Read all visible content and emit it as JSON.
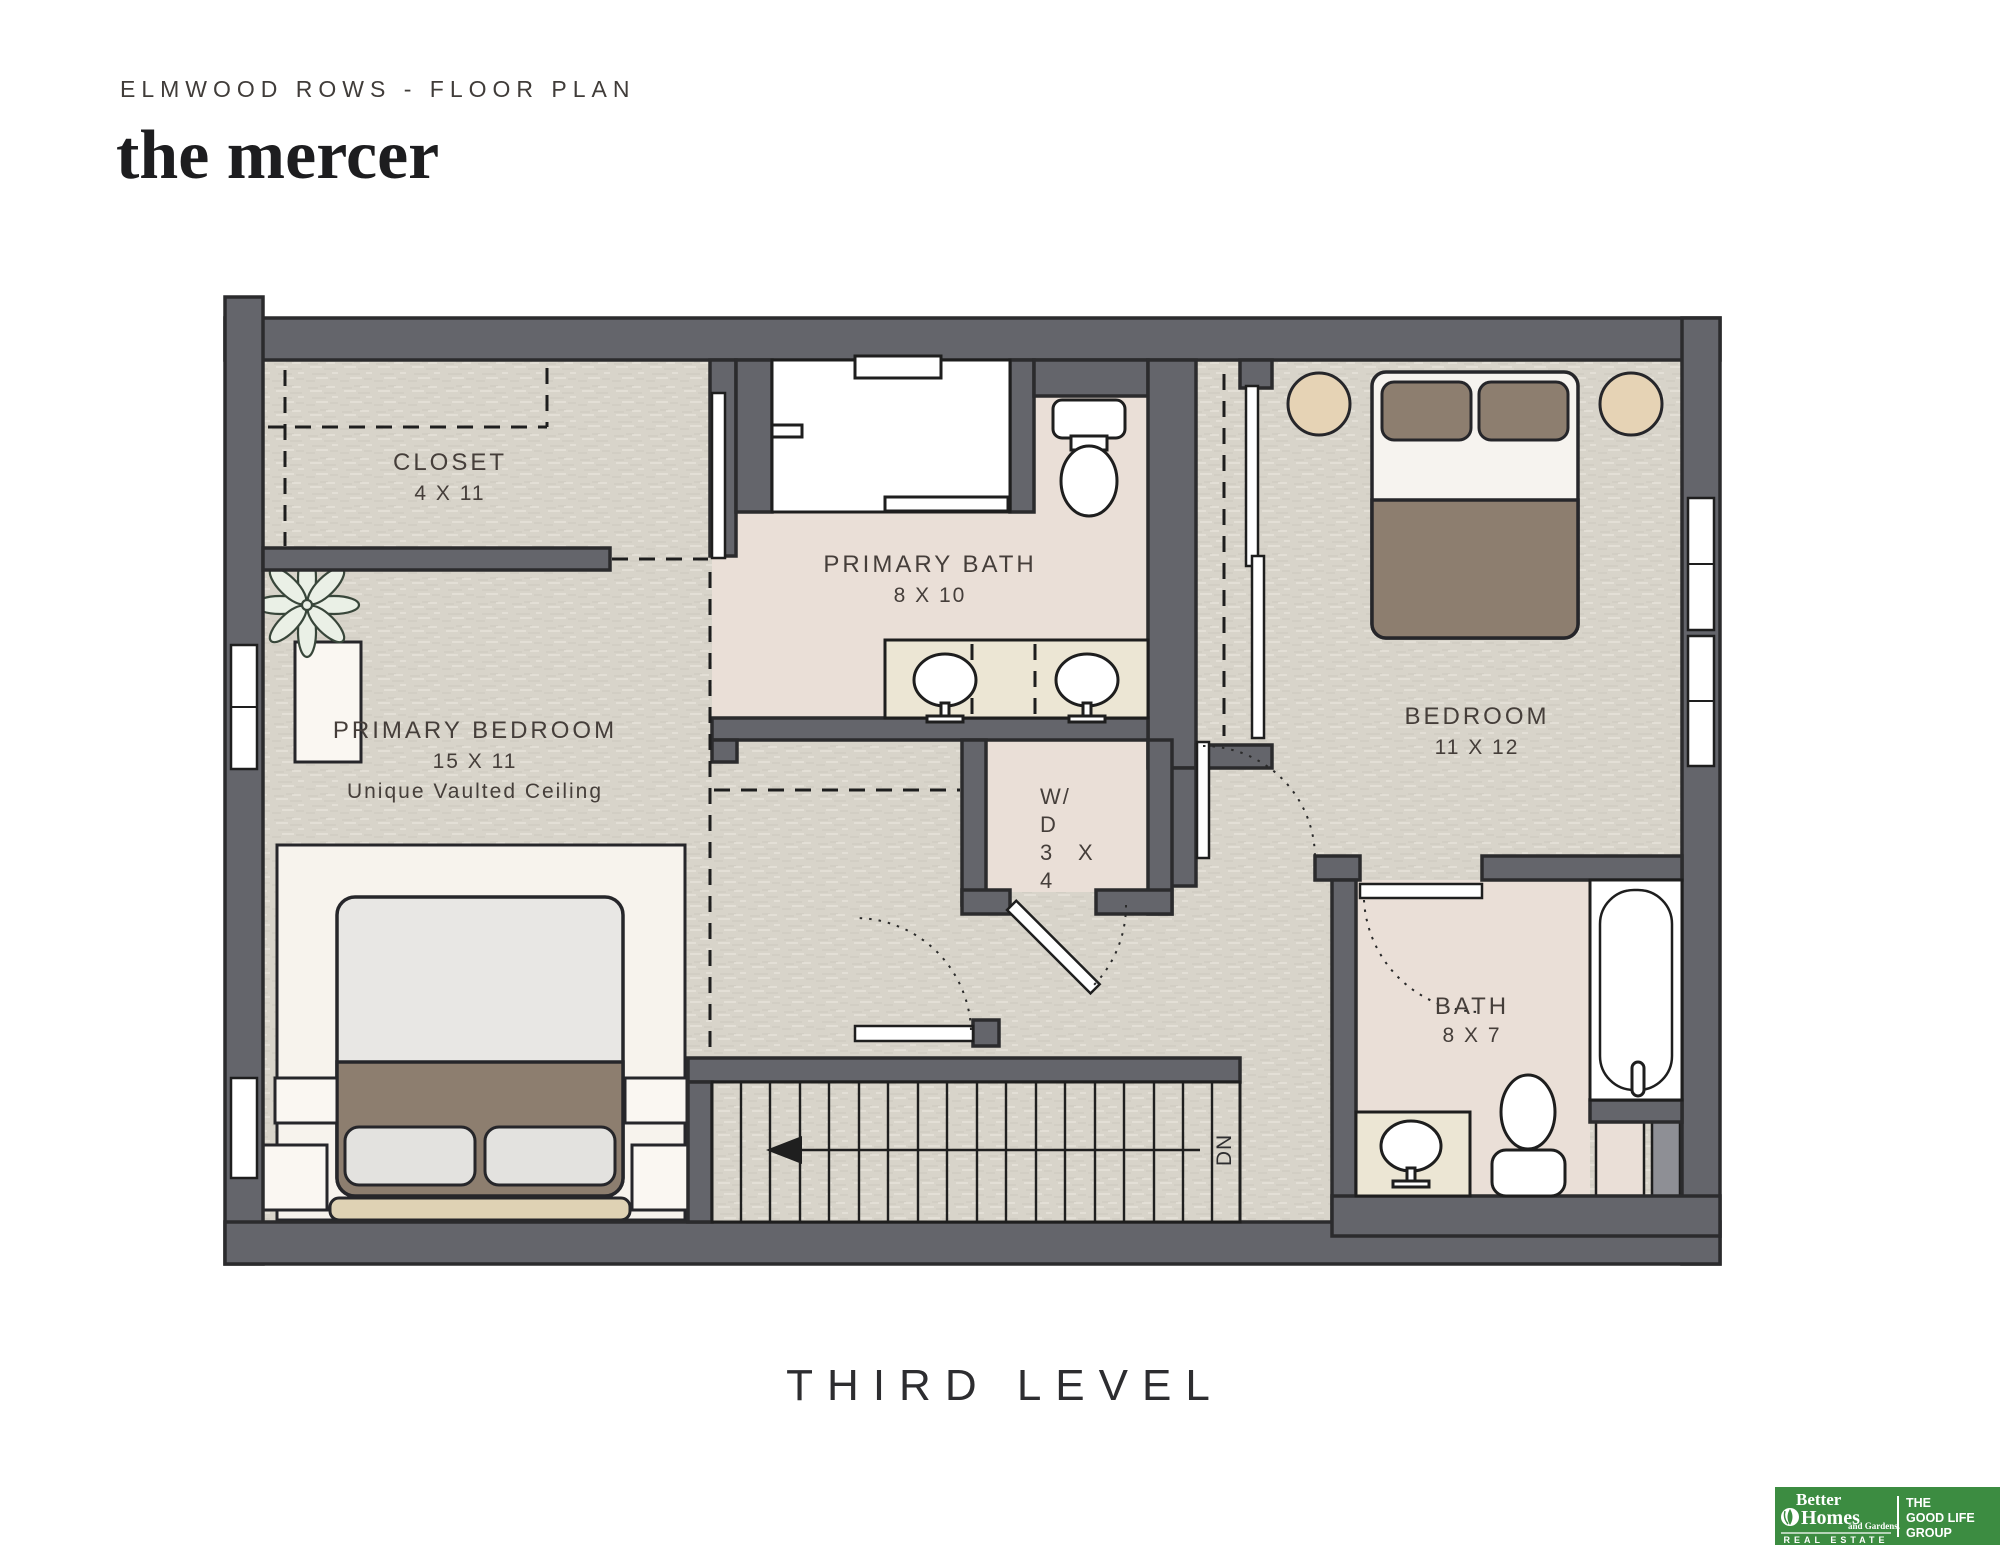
{
  "header": {
    "subtitle": "ELMWOOD ROWS - FLOOR PLAN",
    "title": "the mercer"
  },
  "level_label": "THIRD LEVEL",
  "rooms": {
    "closet": {
      "name": "CLOSET",
      "dims": "4 X 11"
    },
    "primary_bath": {
      "name": "PRIMARY BATH",
      "dims": "8 X 10"
    },
    "primary_bedroom": {
      "name": "PRIMARY BEDROOM",
      "dims": "15 X 11",
      "note": "Unique Vaulted Ceiling"
    },
    "bedroom": {
      "name": "BEDROOM",
      "dims": "11 X 12"
    },
    "laundry": {
      "line1": "W/",
      "line2": "D",
      "line3_left": "3",
      "line3_right": "X",
      "line4": "4"
    },
    "bath": {
      "name": "BATH",
      "dims": "8 X 7"
    },
    "stairs": {
      "down_label": "DN"
    }
  },
  "footer_logo": {
    "brand_top": "Better",
    "brand_main": "Homes",
    "brand_small": "and Gardens.",
    "brand_sub": "REAL ESTATE",
    "group_line1": "THE",
    "group_line2": "GOOD LIFE",
    "group_line3": "GROUP"
  },
  "colors": {
    "wall": "#64656b",
    "wall_outline": "#2b2b2d",
    "carpet": "#d8d4ca",
    "bath_floor": "#eadfd7",
    "vanity": "#ece6d4",
    "furniture_brown": "#8d7e6f",
    "accent_tan": "#e6d3b5",
    "rug": "#f7f3ed",
    "logo_green": "#3c8c41",
    "label_text": "#453e3a"
  }
}
